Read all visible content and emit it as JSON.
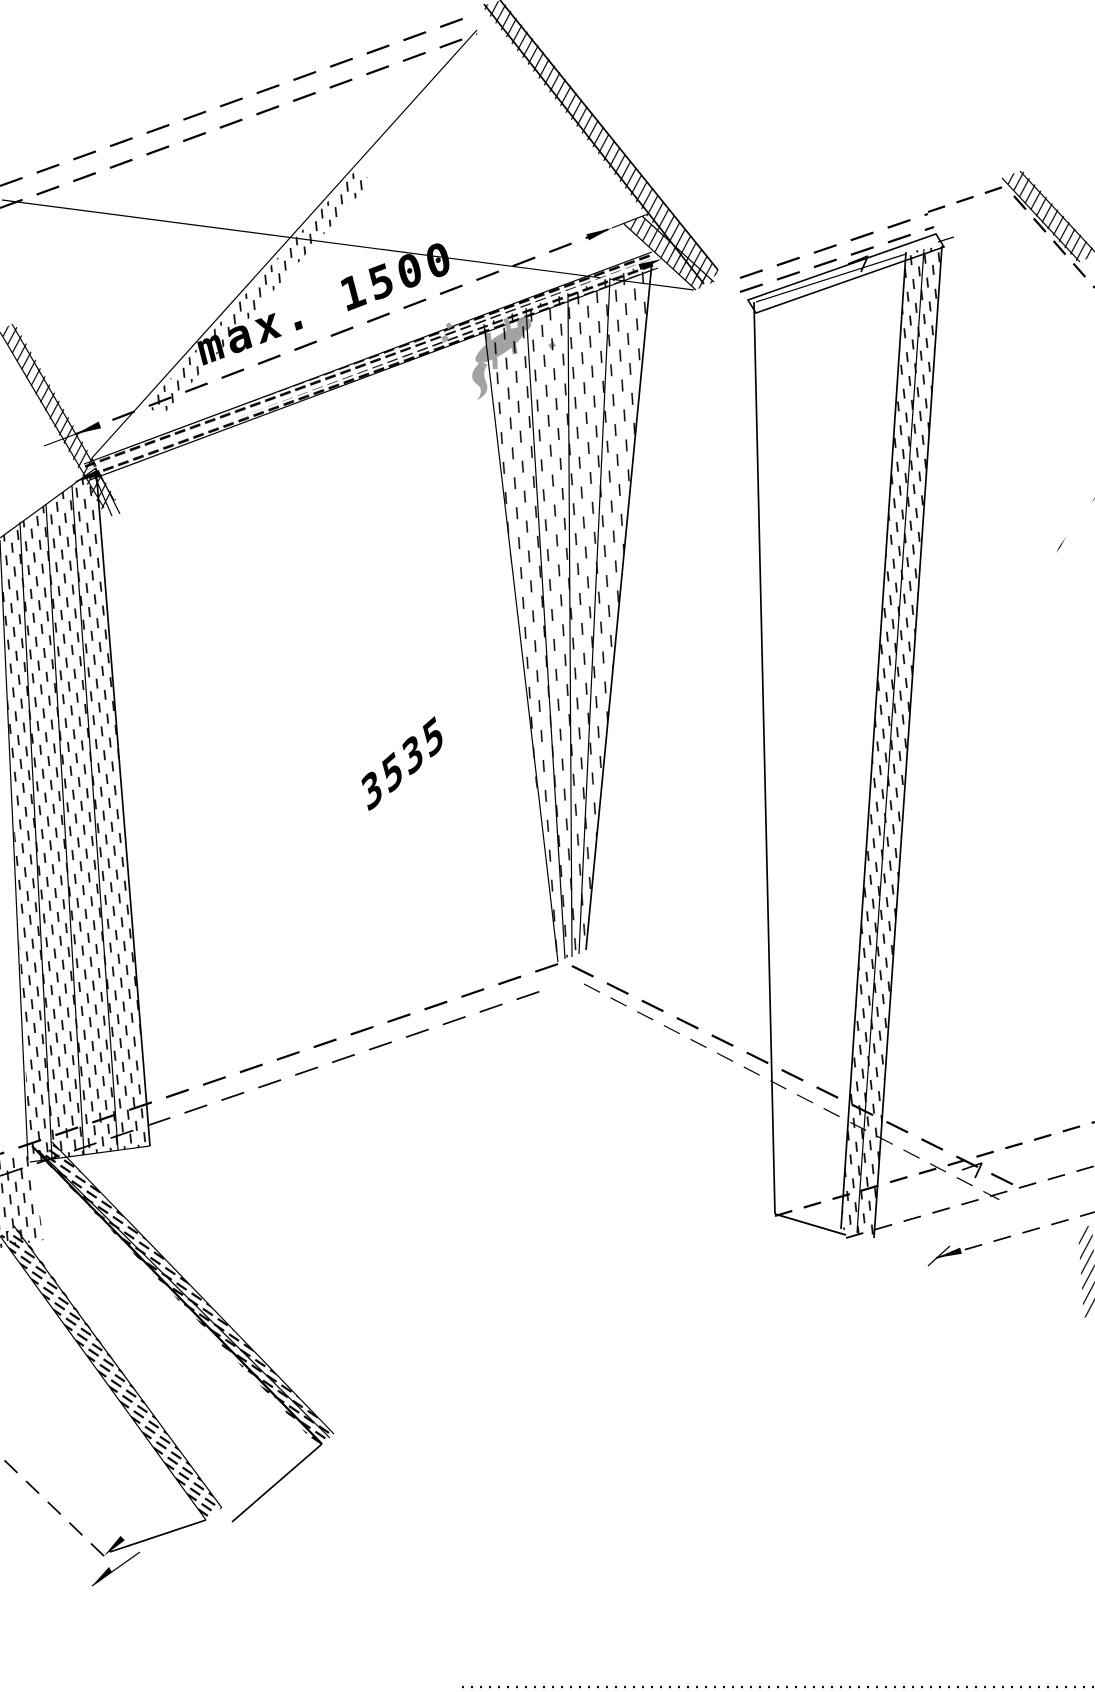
{
  "document": {
    "type": "isometric-technical-drawing",
    "background_color": "#ffffff",
    "line_color": "#000000"
  },
  "annotations": {
    "top_dimension": {
      "label": "max. 1500"
    },
    "length_dimension": {
      "label": "3535"
    }
  },
  "watermark": {
    "name": "gecko-logo",
    "color": "#9b9b9b"
  }
}
